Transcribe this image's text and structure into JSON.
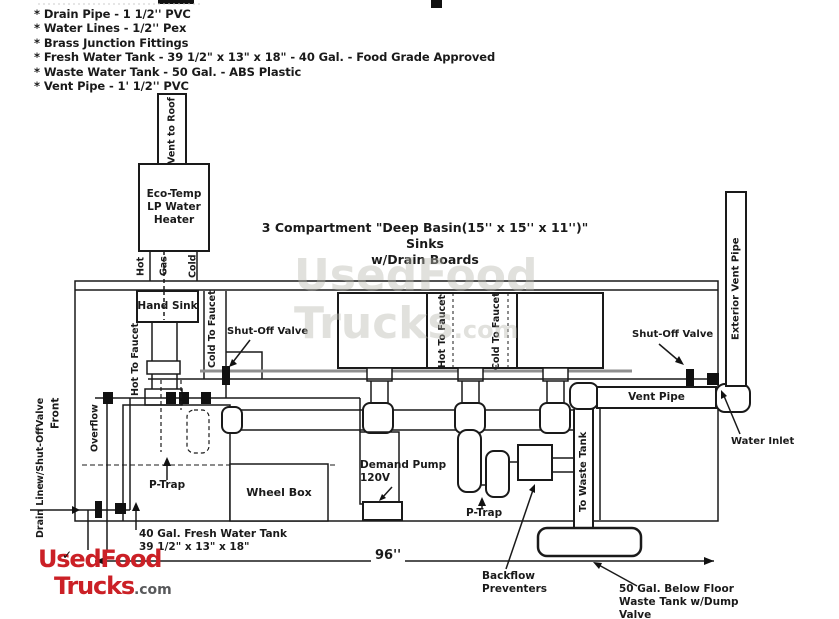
{
  "colors": {
    "ink": "#1a1a1a",
    "logo_red": "#cb2026",
    "logo_gray": "#58595b",
    "counter_gray": "#8f8f8f",
    "watermark_gray": "#b9b9b0"
  },
  "specs": {
    "items": [
      "* Drain Pipe - 1 1/2'' PVC",
      "* Water Lines - 1/2'' Pex",
      "* Brass Junction Fittings",
      "* Fresh Water Tank - 39 1/2\" x 13\" x 18\" - 40 Gal. - Food Grade Approved",
      "* Waste Water Tank - 50 Gal. - ABS Plastic",
      "* Vent Pipe - 1' 1/2'' PVC"
    ]
  },
  "title": {
    "line1": "3 Compartment \"Deep Basin(15'' x 15'' x 11'')\" Sinks",
    "line2": "w/Drain Boards"
  },
  "labels": {
    "vent_to_roof": "Vent to Roof",
    "heater_l1": "Eco-Temp",
    "heater_l2": "LP Water",
    "heater_l3": "Heater",
    "hot": "Hot",
    "gas": "Gas",
    "cold": "Cold",
    "hand_sink": "Hand Sink",
    "hot_to_faucet_hand": "Hot To Faucet",
    "cold_to_faucet_hand": "Cold To Faucet",
    "shut_off_valve_left": "Shut-Off Valve",
    "hot_to_faucet_sink": "Hot To Faucet",
    "cold_to_faucet_sink": "Cold To Faucet",
    "shut_off_valve_right": "Shut-Off Valve",
    "vent_pipe": "Vent Pipe",
    "exterior_vent_pipe": "Exterior Vent Pipe",
    "water_inlet": "Water Inlet",
    "front": "Front",
    "overflow": "Overflow",
    "drain_l1": "Drain Line",
    "drain_l2": "w/Shut-Off",
    "drain_l3": "Valve",
    "p_trap_hand": "P-Trap",
    "p_trap_sink": "P-Trap",
    "wheel_box": "Wheel Box",
    "pump_l1": "Demand Pump",
    "pump_l2": "120V",
    "to_waste_tank": "To Waste Tank",
    "fresh_tank_l1": "40 Gal. Fresh Water Tank",
    "fresh_tank_l2": "39 1/2\" x 13\" x 18\"",
    "dimension": "96''",
    "backflow_l1": "Backflow",
    "backflow_l2": "Preventers",
    "waste_tank_l1": "50 Gal. Below Floor",
    "waste_tank_l2": "Waste Tank w/Dump",
    "waste_tank_l3": "Valve"
  },
  "logo": {
    "word1": "UsedFood",
    "word2": "Trucks",
    "suffix": ".com",
    "check": "✓"
  },
  "watermark": {
    "word1": "UsedFood",
    "word2": "Trucks",
    "suffix": ".com"
  }
}
